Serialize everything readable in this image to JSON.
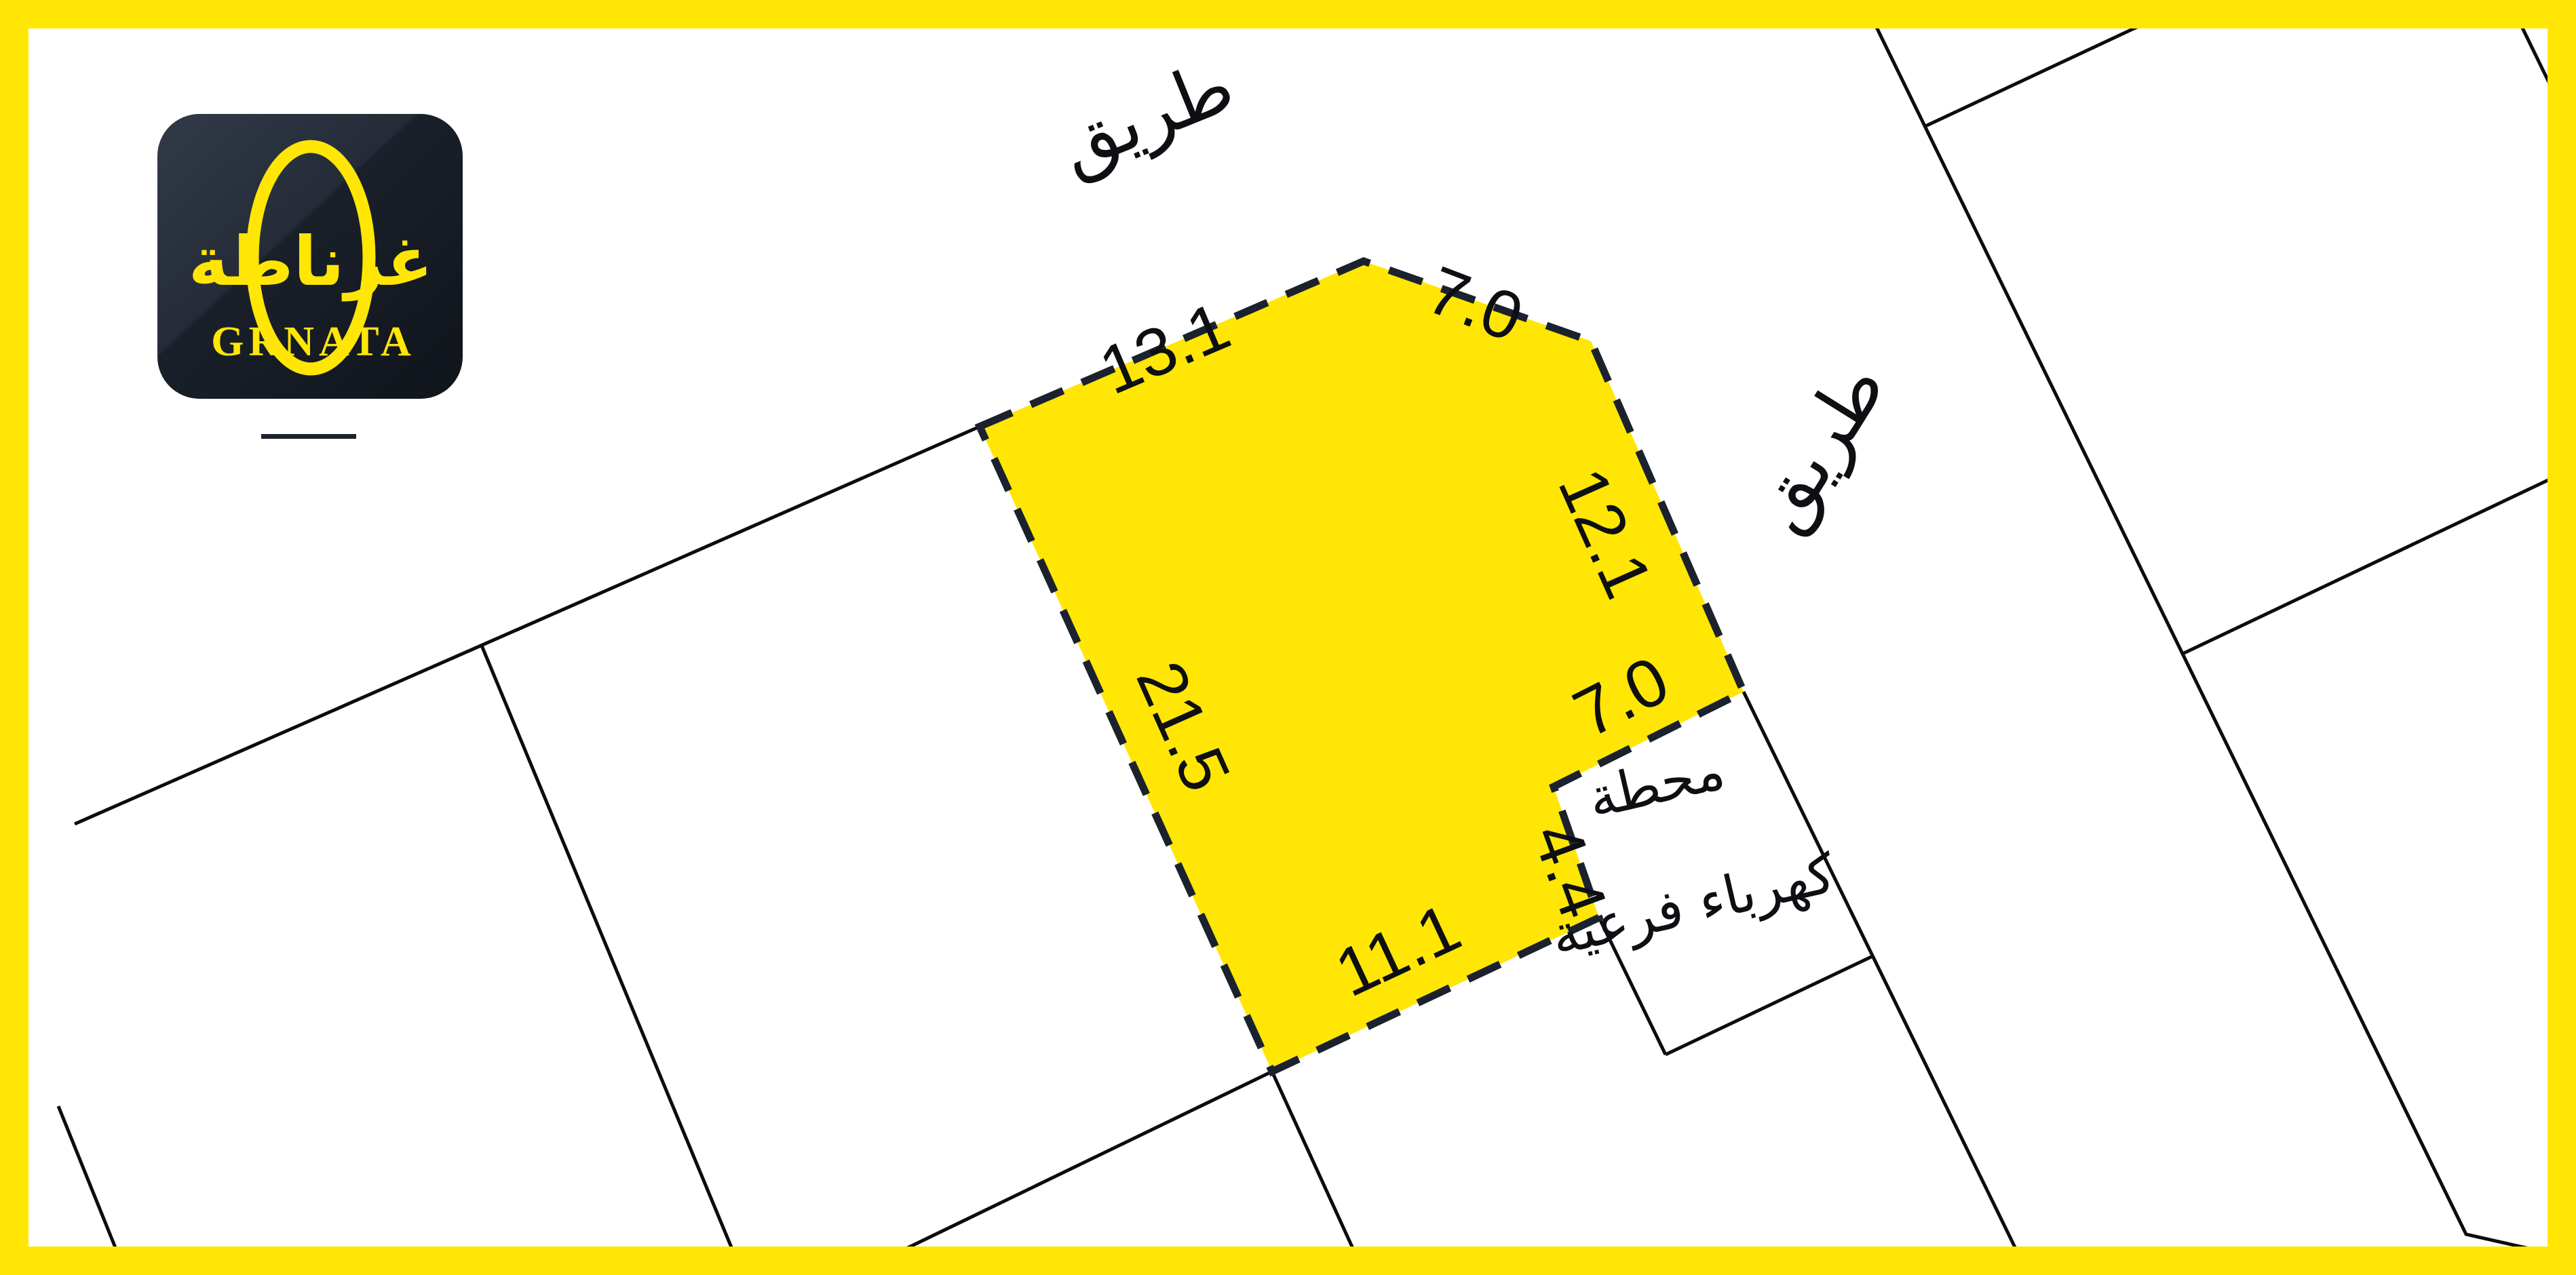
{
  "branding": {
    "logo_arabic": "غرناطة",
    "logo_latin": "GRNATA"
  },
  "map": {
    "road_top": {
      "label": "طريق"
    },
    "road_right": {
      "label": "طريق"
    },
    "plot": {
      "dimensions": {
        "top_left": "13.1",
        "top_right": "7.0",
        "right": "12.1",
        "notch_top": "7.0",
        "notch_side": "4.4",
        "bottom": "11.1",
        "left": "21.5"
      }
    },
    "substation": {
      "line1": "محطة",
      "line2": "كهرباء فرعية"
    }
  },
  "colors": {
    "accent_yellow": "#ffe605",
    "line_dark": "#1b222e",
    "ink_black": "#0a0c10",
    "text_black": "#0d0f12",
    "logo_bg": "#1c232d",
    "white": "#ffffff"
  }
}
